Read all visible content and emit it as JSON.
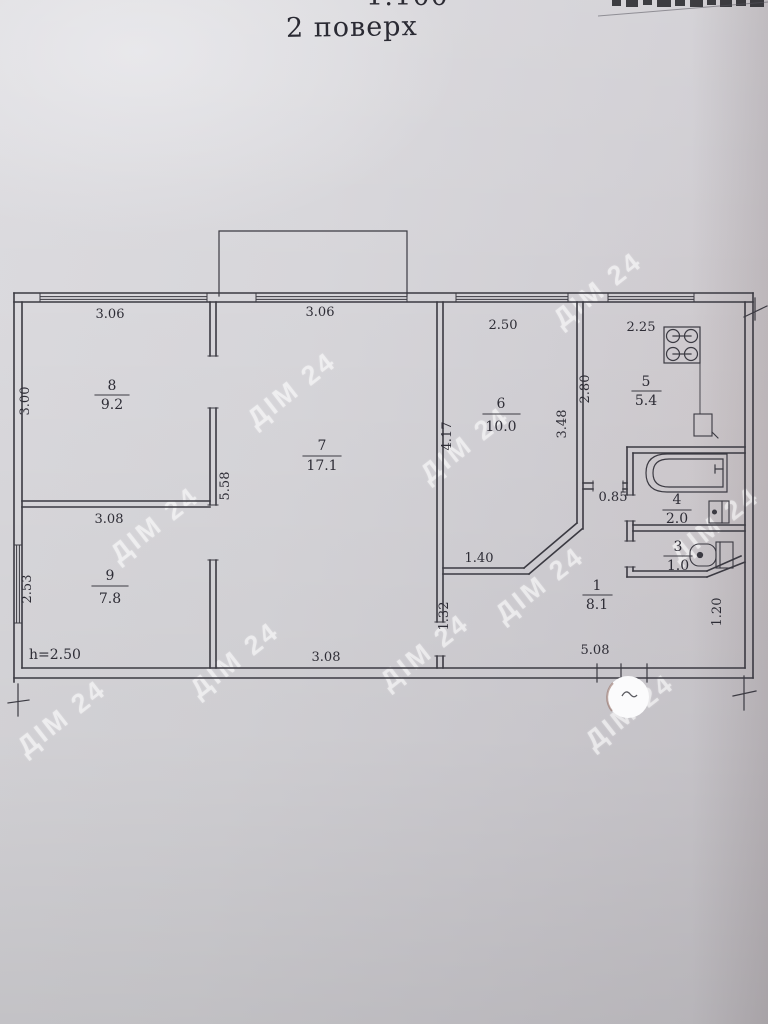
{
  "document": {
    "scale": "1:100",
    "floor_title": "2 поверх"
  },
  "watermark": {
    "text": "ДІМ 24"
  },
  "rooms": {
    "r1": {
      "number": "1",
      "area": "8.1"
    },
    "r3": {
      "number": "3",
      "area": "1.0"
    },
    "r4": {
      "number": "4",
      "area": "2.0"
    },
    "r5": {
      "number": "5",
      "area": "5.4"
    },
    "r6": {
      "number": "6",
      "area": "10.0"
    },
    "r7": {
      "number": "7",
      "area": "17.1"
    },
    "r8": {
      "number": "8",
      "area": "9.2"
    },
    "r9": {
      "number": "9",
      "area": "7.8"
    }
  },
  "dims": {
    "room8_width": "3.06",
    "room8_depth": "3.00",
    "room9_width": "3.08",
    "room9_depth": "2.53",
    "height_note": "h=2.50",
    "room7_width": "3.06",
    "room7_depth": "5.58",
    "room7_bottom": "3.08",
    "room6_width": "2.50",
    "room6_left": "4.17",
    "room6_right": "3.48",
    "room6_bottom": "1.40",
    "kitchen_width": "2.25",
    "kitchen_depth": "2.80",
    "passage": "0.85",
    "hall_left": "1.32",
    "hall_bottom": "5.08",
    "hall_right": "1.20"
  },
  "colors": {
    "line": "#3b3a42",
    "paper": "#d5d4d8",
    "watermark": "rgba(255,255,255,0.5)"
  }
}
